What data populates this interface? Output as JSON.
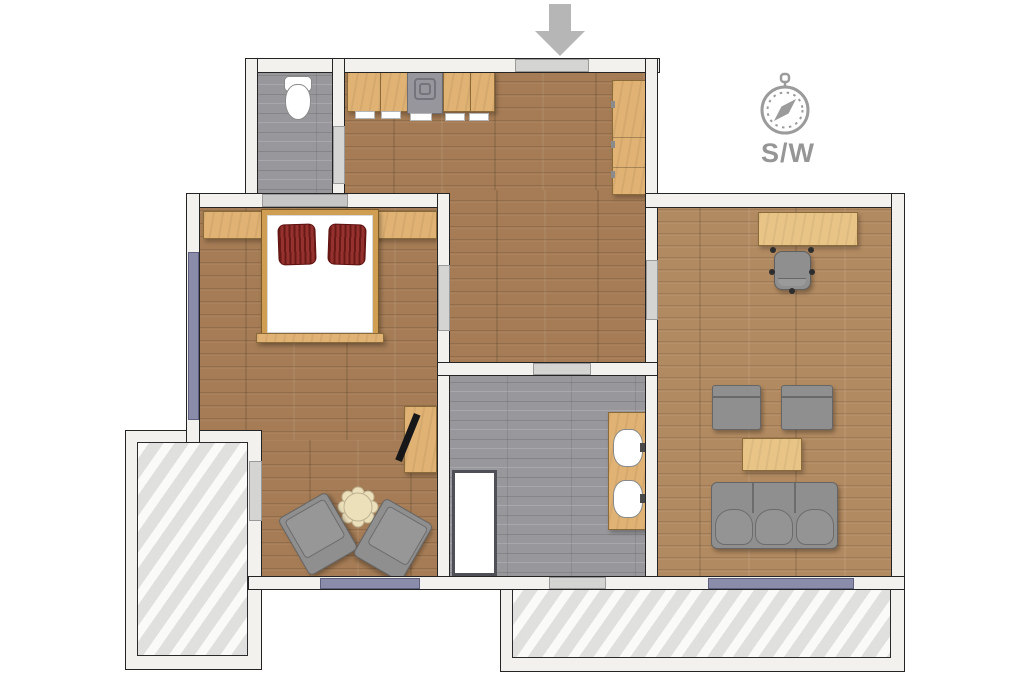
{
  "compass": {
    "label": "S/W",
    "icon": "compass-icon"
  },
  "entrance": {
    "icon": "arrow-down-icon",
    "direction": "down"
  },
  "palette": {
    "wood_floor": "#a57c55",
    "wood_floor_light": "#b28a61",
    "furniture_wood": "#e0b274",
    "tile_gray": "#98989c",
    "sofa_gray": "#8f8f8f",
    "window_purple": "#8a8ca9",
    "wall_fill": "#f2f1ee",
    "wall_outline": "#242424",
    "door_gray": "#d4d4d2",
    "deck_gray": "#eaeae8",
    "pillow_red": "#8c211d",
    "icon_gray": "#9b9b9b"
  },
  "rooms": [
    {
      "id": "wc",
      "floor": "tile",
      "furniture": [
        "toilet"
      ]
    },
    {
      "id": "kitchen-hall",
      "floor": "wood",
      "furniture": [
        "kitchen-counter",
        "stove",
        "tall-cabinet"
      ]
    },
    {
      "id": "bedroom",
      "floor": "wood",
      "furniture": [
        "headboard-shelf",
        "double-bed",
        "two-red-pillows",
        "desk-with-laptop",
        "flower-side-table",
        "armchair",
        "armchair"
      ]
    },
    {
      "id": "bathroom",
      "floor": "tile",
      "furniture": [
        "shower",
        "vanity-with-two-sinks"
      ]
    },
    {
      "id": "living-room",
      "floor": "wood",
      "furniture": [
        "desk",
        "office-chair",
        "armchair",
        "armchair",
        "coffee-table",
        "three-seat-sofa"
      ]
    },
    {
      "id": "balcony",
      "floor": "deck",
      "furniture": []
    },
    {
      "id": "terrace",
      "floor": "deck",
      "furniture": []
    }
  ]
}
